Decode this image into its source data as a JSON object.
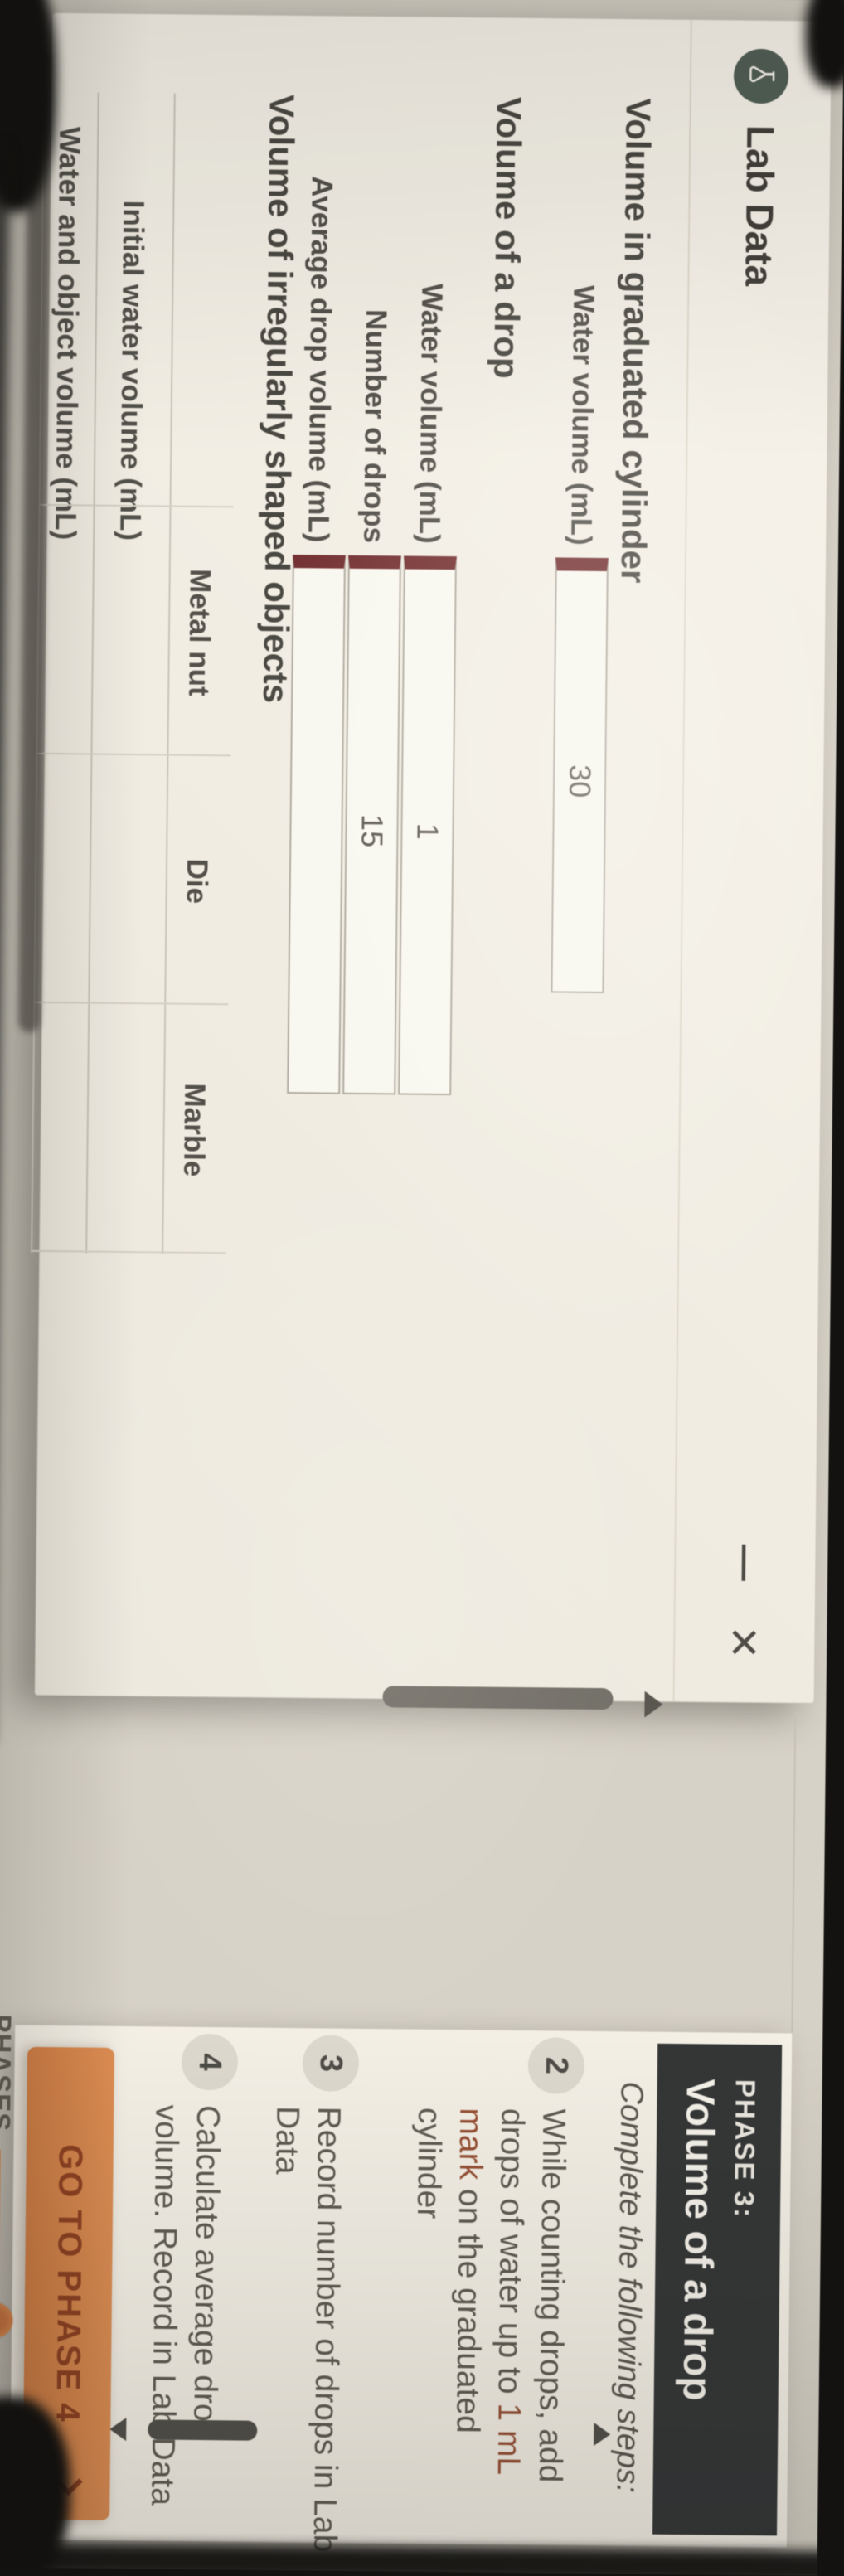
{
  "window": {
    "title": "Lab Data",
    "minimize_glyph": "—",
    "close_glyph": "×"
  },
  "section1": {
    "heading": "Volume in graduated cylinder",
    "row": {
      "label": "Water volume (mL)",
      "value": "30"
    }
  },
  "section2": {
    "heading": "Volume of a drop",
    "rows": [
      {
        "label": "Water volume (mL)",
        "value": "1"
      },
      {
        "label": "Number of drops",
        "value": "15"
      },
      {
        "label": "Average drop volume (mL)",
        "value": ""
      }
    ]
  },
  "section3": {
    "heading": "Volume of irregularly shaped objects",
    "columns": [
      "Metal nut",
      "Die",
      "Marble"
    ],
    "rows": [
      {
        "label": "Initial water volume (mL)",
        "cells": [
          "",
          "",
          ""
        ]
      },
      {
        "label": "Water and object volume (mL)",
        "cells": [
          "",
          "",
          ""
        ]
      }
    ]
  },
  "phase_panel": {
    "kicker": "PHASE 3:",
    "title": "Volume of a drop",
    "intro": "Complete the following steps:",
    "step2": {
      "num": "2",
      "l1": "While counting drops, add",
      "l2a": "drops of water up to ",
      "l2b": "1 mL",
      "l3a": "mark",
      "l3b": " on the graduated",
      "l4": "cylinder"
    },
    "step3": {
      "num": "3",
      "l1": "Record number of drops in Lab",
      "l2": "Data"
    },
    "step4": {
      "num": "4",
      "l1": "Calculate average drop",
      "l2": "volume. Record in Lab Data"
    }
  },
  "footer": {
    "go_button": "GO TO PHASE 4",
    "phases_label": "PHASES"
  },
  "colors": {
    "accent_orange": "#e5813c",
    "input_accent_maroon": "#7a2629",
    "panel_header_dark": "#2f3234",
    "logo_green": "#4a5c52"
  }
}
